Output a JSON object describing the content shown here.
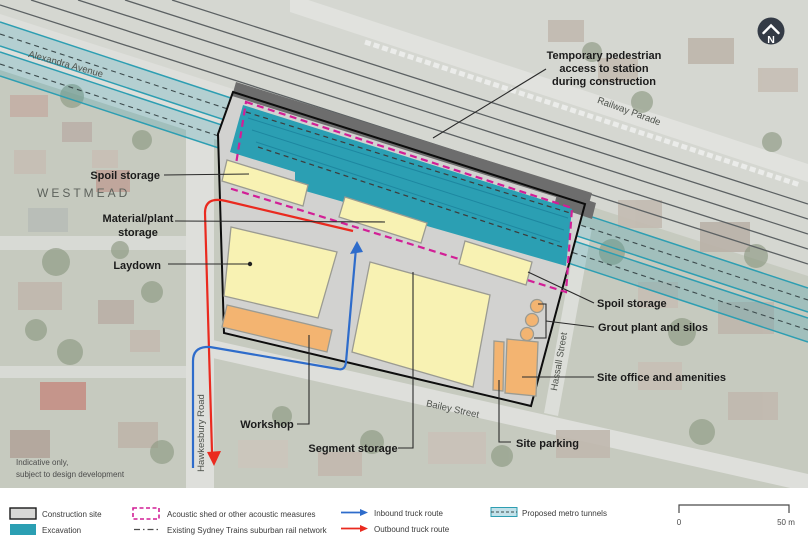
{
  "map": {
    "area_label": "WESTMEAD",
    "north_label": "N",
    "note_line1": "Indicative only,",
    "note_line2": "subject to design development",
    "streets": {
      "alexandra": "Alexandra Avenue",
      "railway": "Railway Parade",
      "hawkesbury": "Hawkesbury Road",
      "bailey": "Bailey Street",
      "hassall": "Hassall Street"
    },
    "annotations": {
      "access_line1": "Temporary pedestrian",
      "access_line2": "access to station",
      "access_line3": "during construction",
      "spoil_left": "Spoil storage",
      "material_line1": "Material/plant",
      "material_line2": "storage",
      "laydown": "Laydown",
      "workshop": "Workshop",
      "segment": "Segment storage",
      "site_parking": "Site parking",
      "office": "Site office and amenities",
      "grout": "Grout plant and silos",
      "spoil_right": "Spoil storage"
    }
  },
  "legend": {
    "construction_site": "Construction site",
    "excavation": "Excavation",
    "acoustic": "Acoustic shed or other acoustic measures",
    "rail_network": "Existing Sydney Trains suburban rail network",
    "inbound": "Inbound truck route",
    "outbound": "Outbound truck route",
    "tunnels": "Proposed metro tunnels"
  },
  "scale_bar": {
    "start": "0",
    "end": "50 m"
  },
  "colors": {
    "excavation": "#2b9fb3",
    "acoustic": "#d21f96",
    "inbound": "#2e6ccb",
    "outbound": "#ea2a1f",
    "tunnel": "#2d9eb2",
    "zone_yellow": "#f8f2b3",
    "zone_orange": "#f3b471",
    "construction_fill": "#d2d2d0",
    "access_band": "#6d6d6d"
  }
}
